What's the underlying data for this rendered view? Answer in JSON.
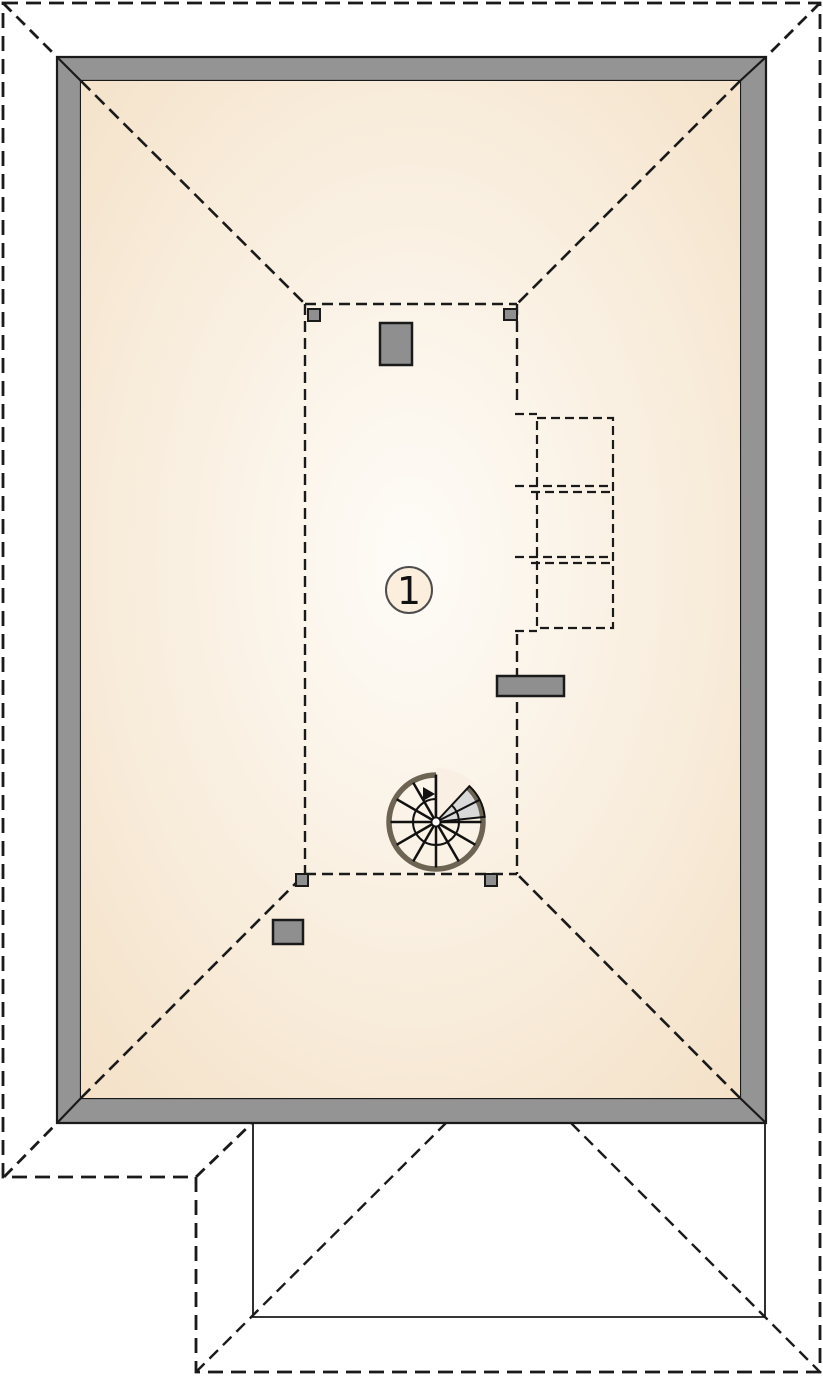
{
  "room": {
    "label": "1"
  },
  "colors": {
    "background": "#ffffff",
    "wall_fill": "#949494",
    "floor_center": "#fefcf8",
    "floor_mid": "#f9eede",
    "floor_edge": "#f4e1c8",
    "fixture_fill": "#8f8f8f",
    "stair_tread": "#d9d9d9",
    "stair_rim": "#6e6454",
    "stair_gap": "#f9efe2",
    "badge_fill": "#fbeedc"
  }
}
